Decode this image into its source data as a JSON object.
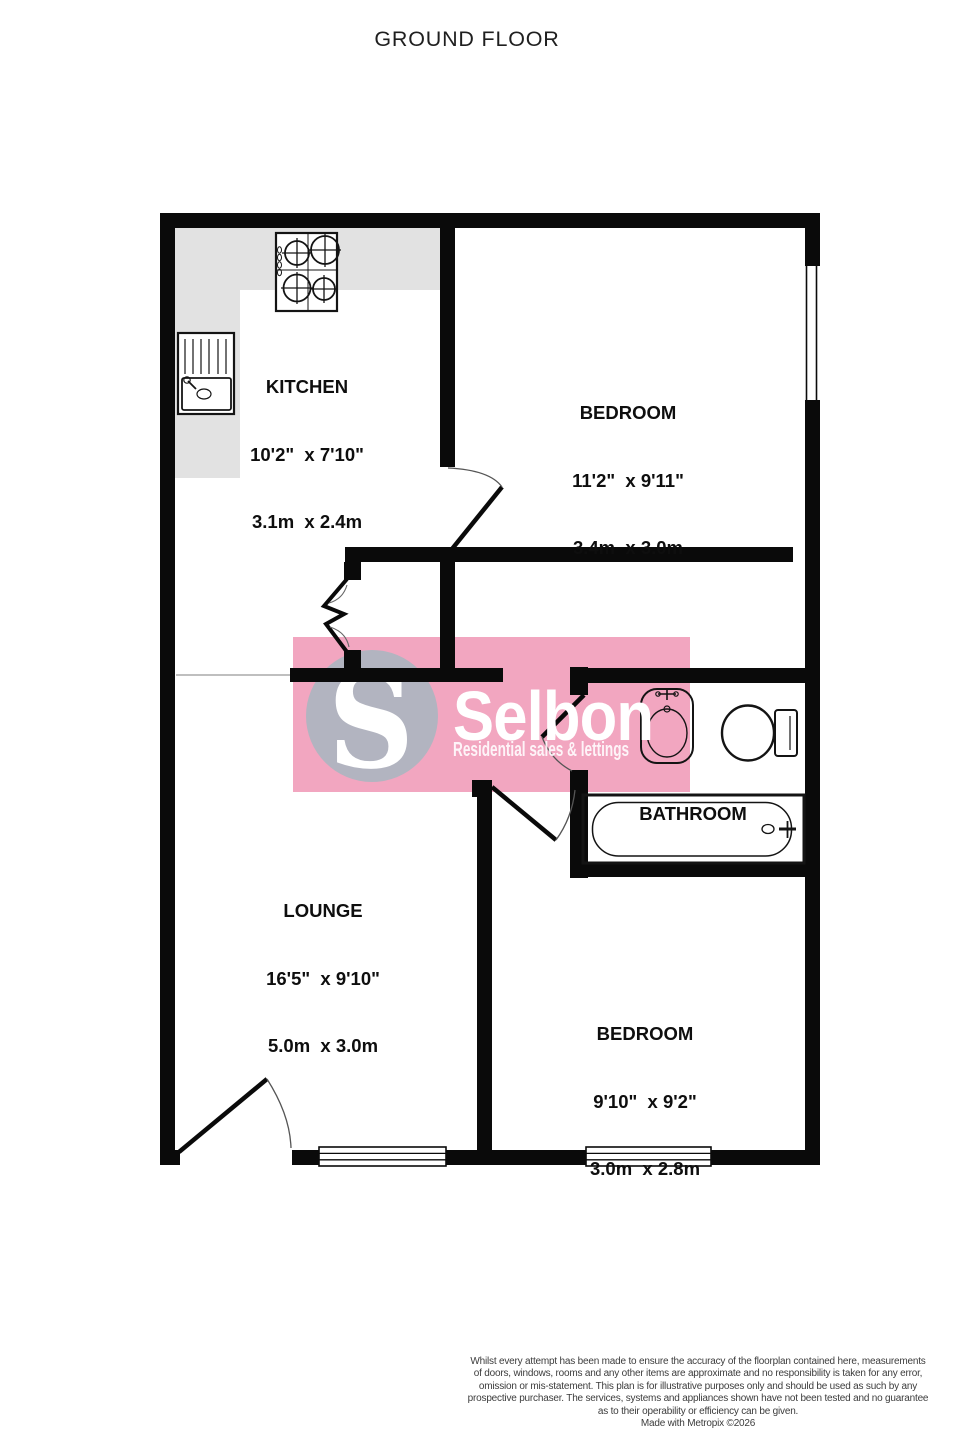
{
  "title": "GROUND FLOOR",
  "rooms": {
    "kitchen": {
      "name": "KITCHEN",
      "imperial": "10'2\"  x 7'10\"",
      "metric": "3.1m  x 2.4m"
    },
    "bedroom1": {
      "name": "BEDROOM",
      "imperial": "11'2\"  x 9'11\"",
      "metric": "3.4m  x 3.0m"
    },
    "lounge": {
      "name": "LOUNGE",
      "imperial": "16'5\"  x 9'10\"",
      "metric": "5.0m  x 3.0m"
    },
    "bathroom": {
      "name": "BATHROOM"
    },
    "bedroom2": {
      "name": "BEDROOM",
      "imperial": "9'10\"  x 9'2\"",
      "metric": "3.0m  x 2.8m"
    }
  },
  "watermark": {
    "initial": "S",
    "brand": "Selbon",
    "tagline": "Residential sales & lettings",
    "band_color": "#f2a6c0",
    "circle_color": "#b2b4c0"
  },
  "fixtures": [
    "stove-icon",
    "kitchen-sink-icon",
    "washbasin-icon",
    "toilet-icon",
    "bathtub-icon",
    "window-icon",
    "door-icon"
  ],
  "colors": {
    "wall": "#0a0a0a",
    "counter": "#e2e2e2",
    "open-plan-line": "#999999"
  },
  "footer": {
    "lines": [
      "Whilst every attempt has been made to ensure the accuracy of the floorplan contained here, measurements",
      "of doors, windows, rooms and any other items are approximate and no responsibility is taken for any error,",
      "omission or mis-statement. This plan is for illustrative purposes only and should be used as such by any",
      "prospective purchaser. The services, systems and appliances shown have not been tested and no guarantee",
      "as to their operability or efficiency can be given."
    ],
    "credit": "Made with Metropix ©2026"
  }
}
